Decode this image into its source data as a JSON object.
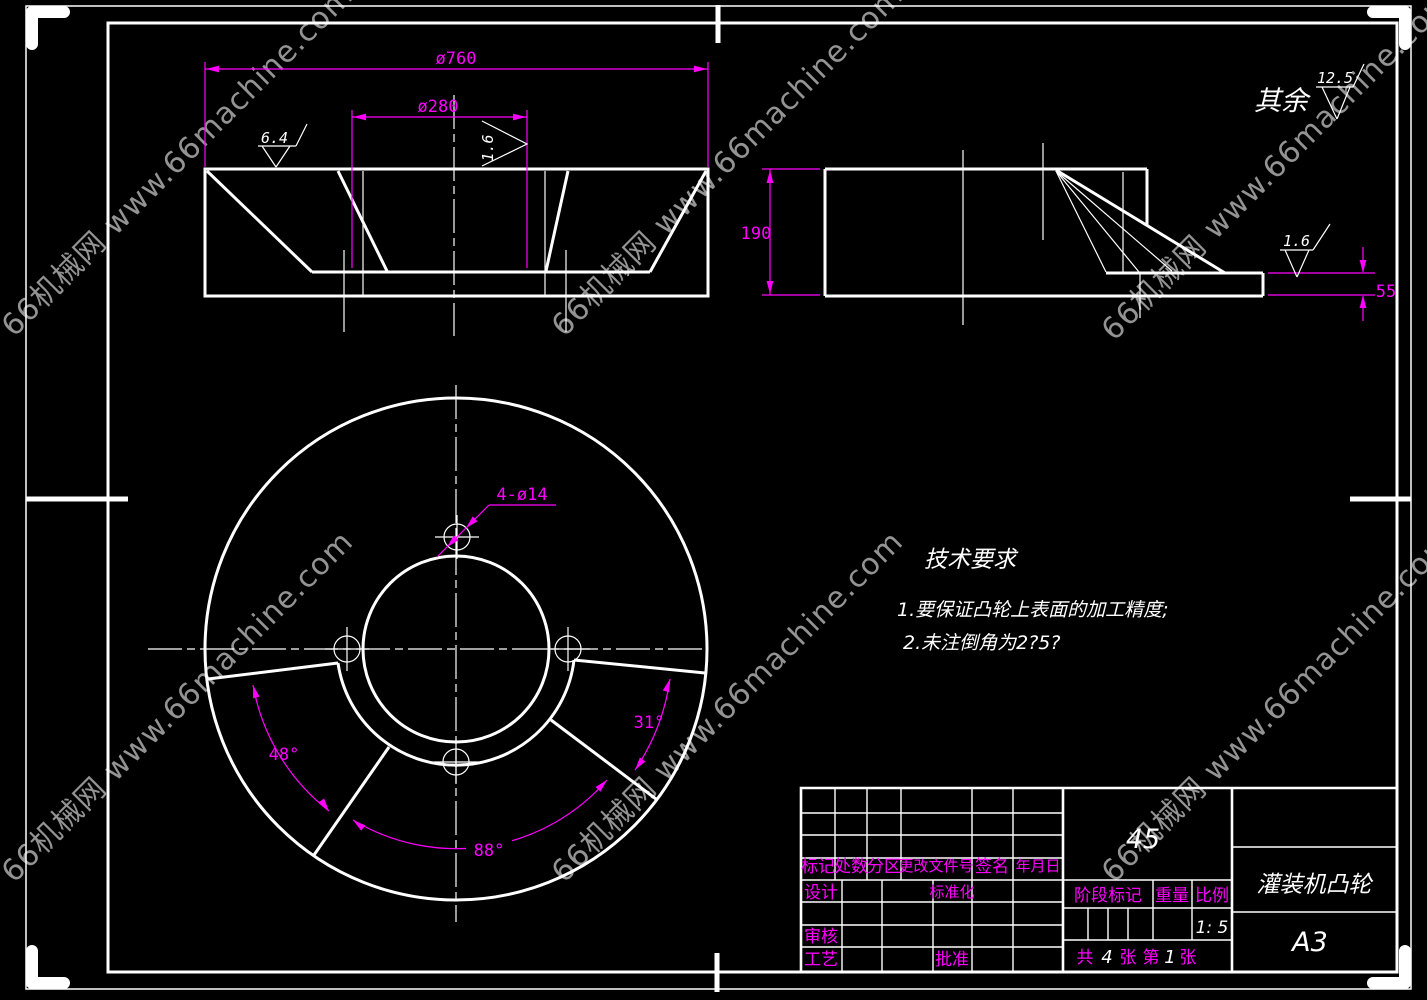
{
  "watermark": {
    "text": "66机械网 www.66machine.com"
  },
  "default_roughness": {
    "prefix": "其余",
    "value": "12.5"
  },
  "section_view": {
    "dia_outer": "ø760",
    "dia_inner": "ø280",
    "rough_left": "6.4",
    "rough_right": "1.6"
  },
  "side_view": {
    "height": "190",
    "step": "55",
    "rough": "1.6"
  },
  "plan_view": {
    "holes": "4-ø14",
    "angle_left": "48°",
    "angle_right": "31°",
    "angle_bottom": "88°"
  },
  "tech_req": {
    "title": "技术要求",
    "item1": "1.要保证凸轮上表面的加工精度;",
    "item2": "2.未注倒角为2?5?"
  },
  "title_block": {
    "mark": "标记",
    "count": "处数",
    "zone": "分区",
    "change_doc": "更改文件号",
    "sign": "签名",
    "date": "年月日",
    "design": "设计",
    "standardize": "标准化",
    "review": "审核",
    "process": "工艺",
    "approve": "批准",
    "stage_mark": "阶段标记",
    "weight": "重量",
    "scale": "比例",
    "scale_value": "1: 5",
    "material": "45",
    "sheet_gong": "共",
    "sheet_total": "4",
    "sheet_zhang1": "张",
    "sheet_di": "第",
    "sheet_num": "1",
    "sheet_zhang2": "张",
    "part_name": "灌装机凸轮",
    "paper_size": "A3"
  },
  "colors": {
    "background": "#000000",
    "line": "#ffffff",
    "dim": "#ff00ff",
    "watermark": "#bdbdbd"
  }
}
